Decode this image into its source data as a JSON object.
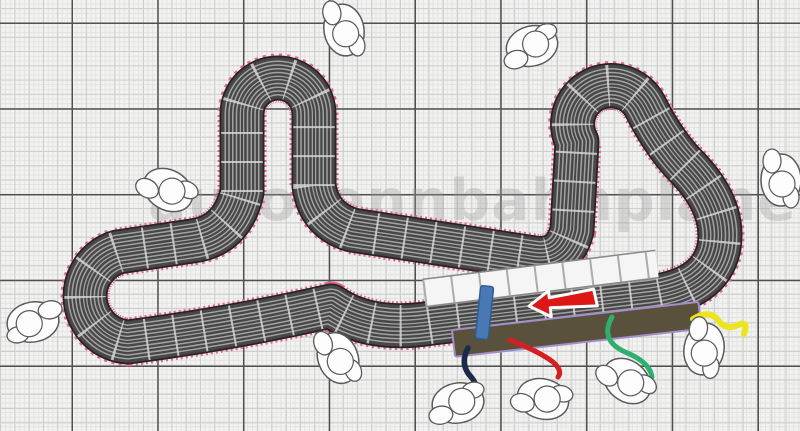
{
  "page": {
    "title": "Slot car track layout plan on grid paper"
  },
  "watermark": {
    "text": "autorennbahnplaner"
  },
  "grid": {
    "minor_step_px": 4.76,
    "medium_step_px": 14.29,
    "major_step_px": 85.75
  },
  "track": {
    "lanes": 4,
    "border_style": "pink serrated edge",
    "features": [
      "top-left hairpin",
      "far-left 180-degree hairpin",
      "top-right S-curves",
      "right 180-degree bend",
      "main straight",
      "crossing diagonal straight"
    ]
  },
  "objects": {
    "direction_arrow": {
      "points": "left",
      "style": "red with white outline"
    },
    "start_pieces": {
      "description": "white straight track sections",
      "count": 8
    },
    "connector_track": {
      "description": "blue power connector piece"
    },
    "pit_wall": {
      "description": "dark brown pit wall strip with lavender outline"
    },
    "cables": [
      {
        "name": "red-cable"
      },
      {
        "name": "navy-cable"
      },
      {
        "name": "green-cable"
      },
      {
        "name": "yellow-cable"
      }
    ],
    "trees": {
      "count": 10,
      "style": "white outlined bushes"
    }
  },
  "colors": {
    "grid-bg": "#f2f2f0",
    "grid-minor": "#e3e3e3",
    "grid-medium": "#cdcdcd",
    "grid-major": "#505050",
    "track-surface": "#474747",
    "track-edge": "#2b2126",
    "track-line": "#a2a2a2",
    "track-joint": "#dcdcdc",
    "border-pink": "#e4688e",
    "white-piece": "#f5f5f5",
    "white-piece-edge": "#898989",
    "white-piece-joint": "#ababab",
    "arrow-red": "#dd1616",
    "connector-blue": "#4879b5",
    "pit-wall": "#59513c",
    "pit-wall-outline": "#a violet",
    "pit-outline": "#a28fc9",
    "cable-red": "#d42020",
    "cable-navy": "#1c2b4a",
    "cable-green": "#2fae6e",
    "cable-yellow": "#ece41c",
    "tree-fill": "#fdfdfd",
    "tree-stroke": "#5a5a5a",
    "watermark-color": "#9a9a9a"
  }
}
